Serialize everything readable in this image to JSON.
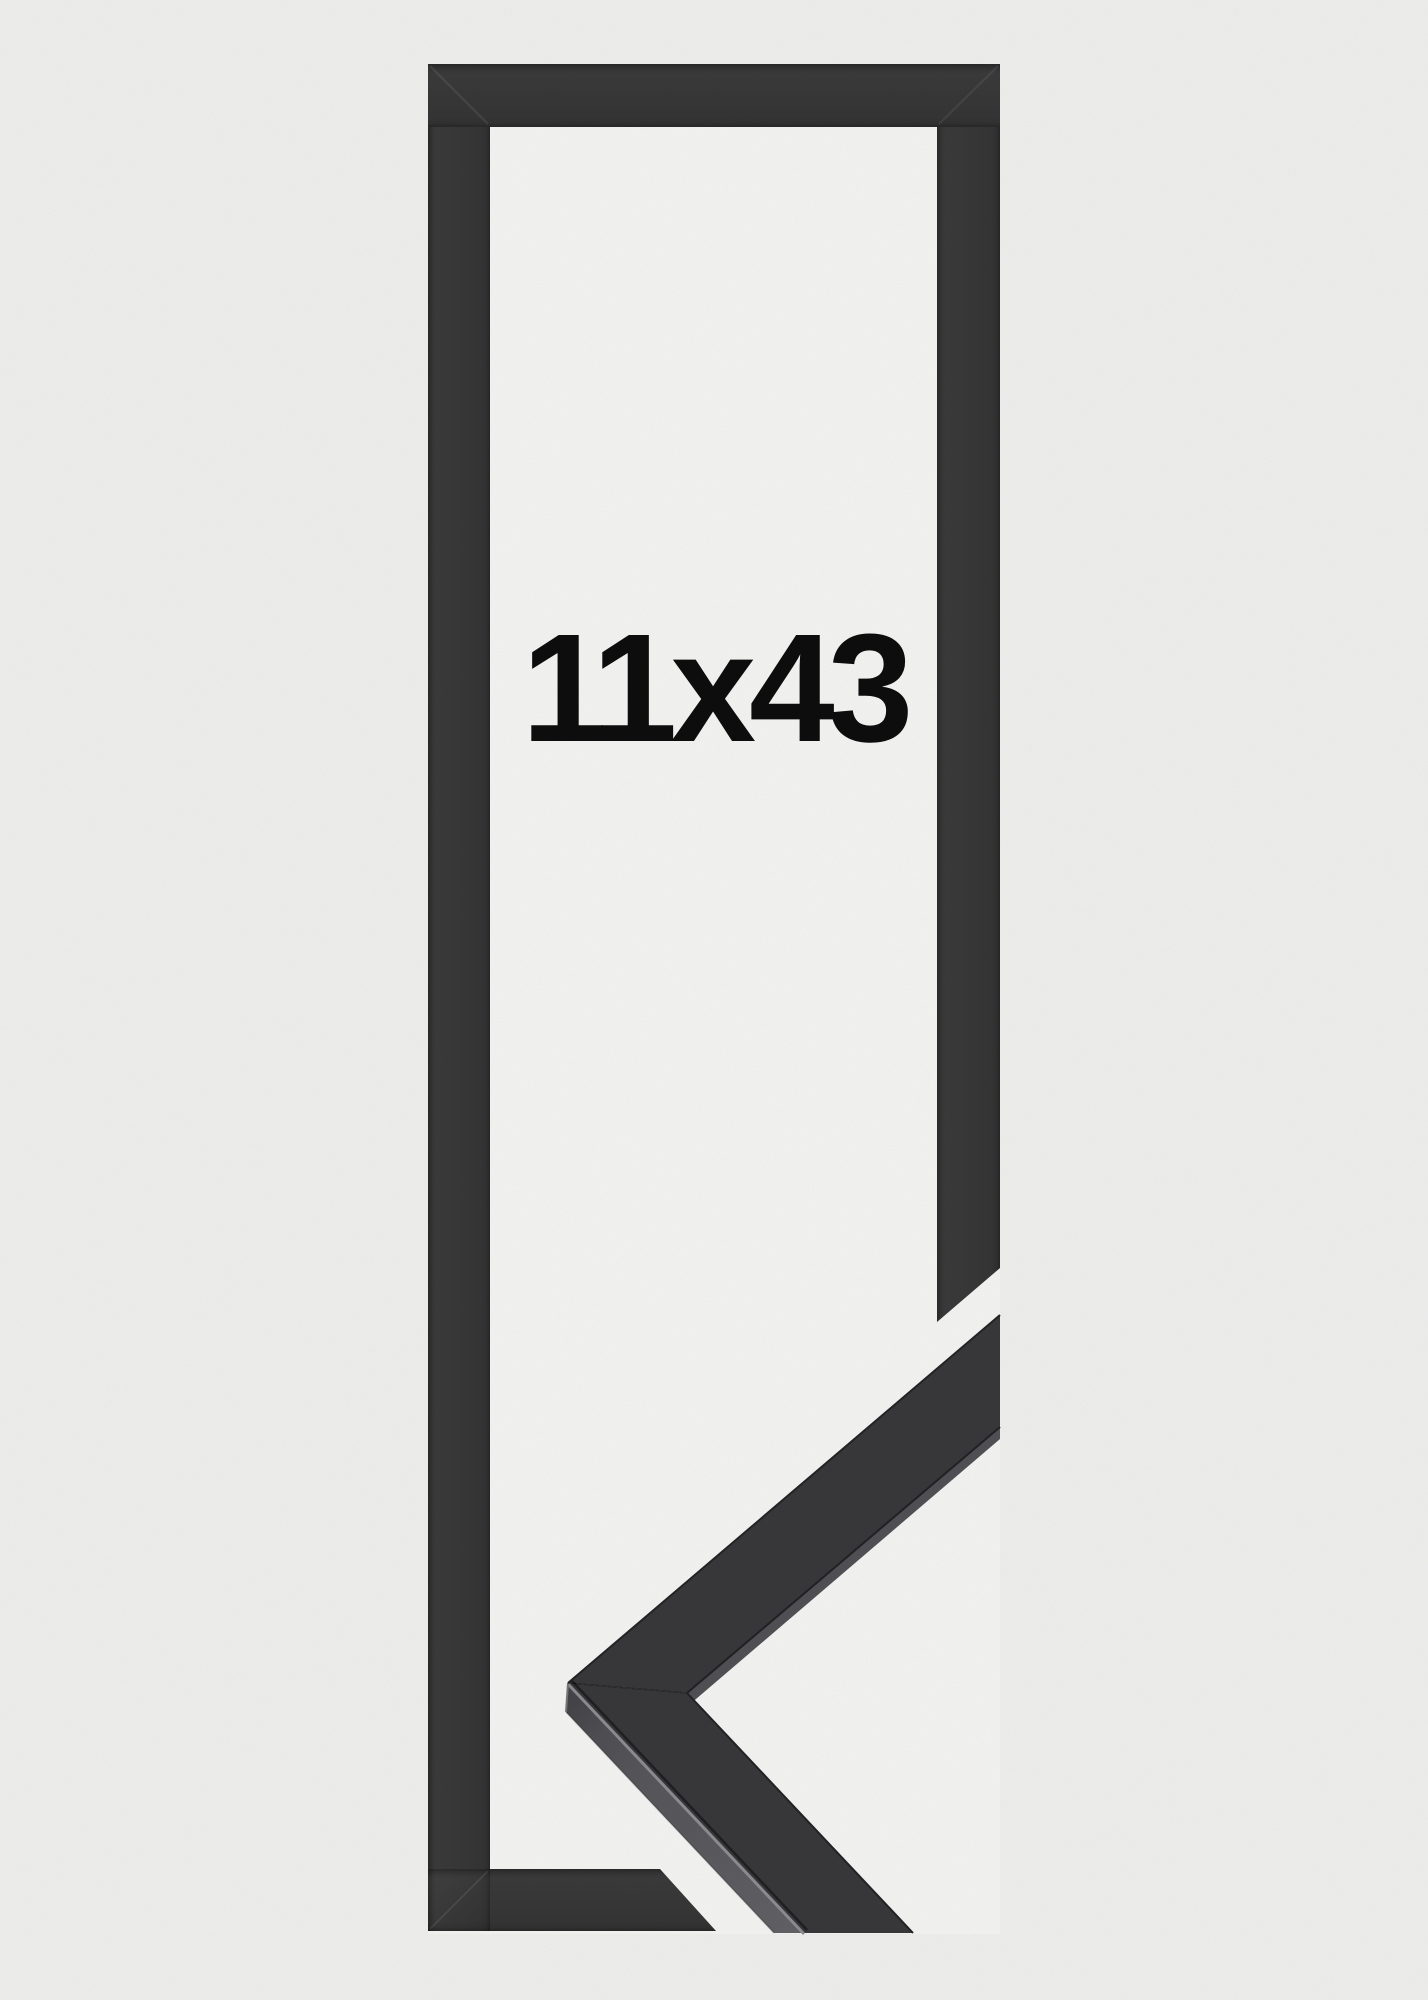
{
  "product_photo": {
    "label": {
      "text": "11x43"
    },
    "colors": {
      "page_background": "#f0f0ef",
      "photo_backdrop": "#f5f5f4",
      "frame_face": "#373738",
      "sample_top_face": "#39393b",
      "sample_side_face": "#515156",
      "label_text": "#0e0e0e"
    }
  }
}
